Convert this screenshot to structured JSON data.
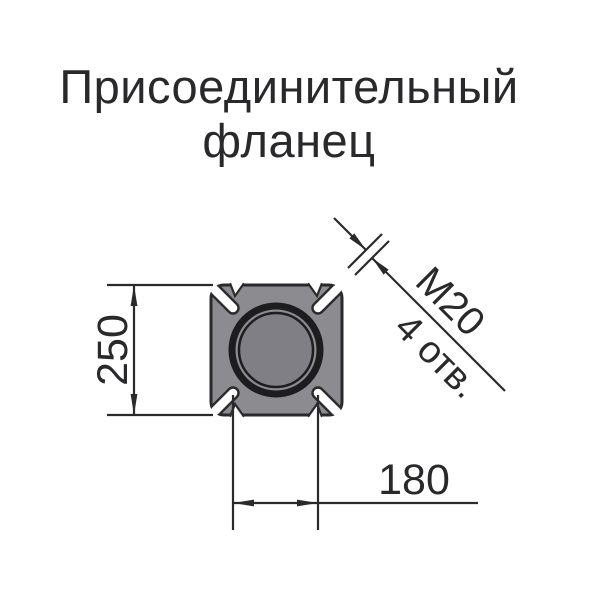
{
  "title": {
    "line1": "Присоединительный",
    "line2": "фланец"
  },
  "drawing": {
    "type": "technical-drawing-flange-front-view",
    "dimensions": {
      "flange_size": "250",
      "bolt_spacing": "180",
      "thread": "М20",
      "holes": "4 отв."
    },
    "features": {
      "bolt_slots": 4,
      "slot_orientation_deg": 45,
      "center_bore": true
    }
  },
  "colors": {
    "background": "#ffffff",
    "body": "#8b8b90",
    "bore": "#7f7f85",
    "ring": "#1d1d1f",
    "line": "#2a2a2c",
    "text": "#29292b"
  }
}
